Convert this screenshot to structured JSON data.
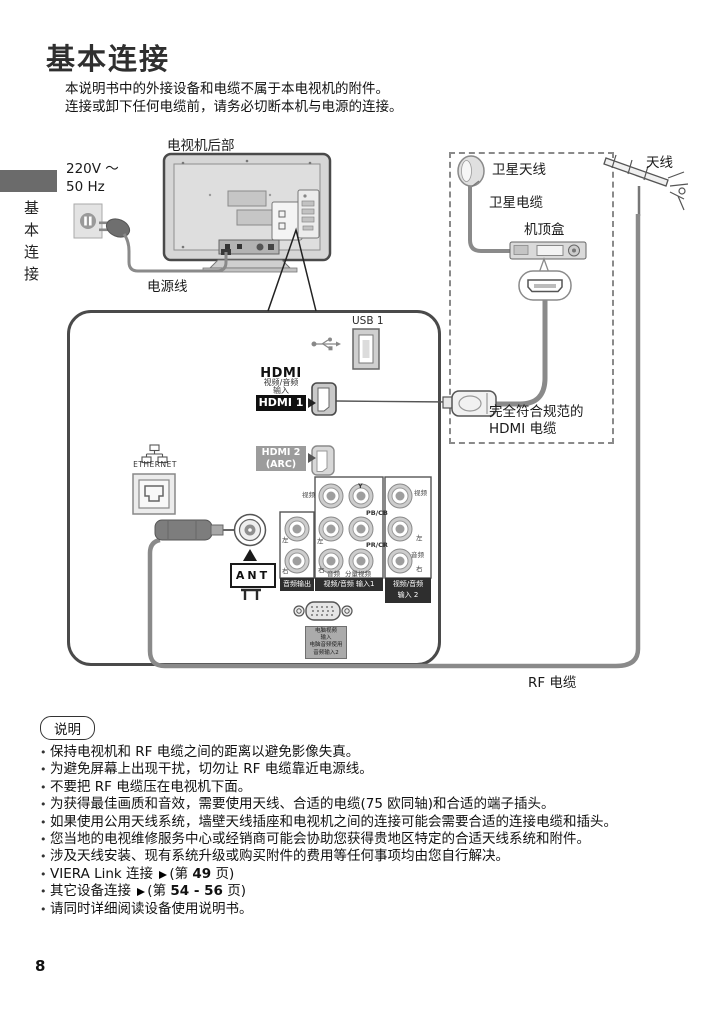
{
  "page_number": "8",
  "title": "基本连接",
  "intro_line1": "本说明书中的外接设备和电缆不属于本电视机的附件。",
  "intro_line2": "连接或卸下任何电缆前，请务必切断本机与电源的连接。",
  "sidebar_label": "基本连接",
  "diagram": {
    "tv_rear_label": "电视机后部",
    "voltage_line1": "220V ～",
    "voltage_line2": "50 Hz",
    "power_cord_label": "电源线",
    "satellite_dish_label": "卫星天线",
    "satellite_cable_label": "卫星电缆",
    "set_top_box_label": "机顶盒",
    "antenna_label": "天线",
    "hdmi_cable_label_line1": "完全符合规范的",
    "hdmi_cable_label_line2": "HDMI 电缆",
    "rf_cable_label": "RF 电缆",
    "usb_label": "USB 1",
    "hdmi_logo": "HDMI",
    "hdmi_caption_line1": "视频/音频",
    "hdmi_caption_line2": "输入",
    "hdmi1_label": "HDMI 1",
    "hdmi2_label_line1": "HDMI 2",
    "hdmi2_label_line2": "(ARC)",
    "ethernet_label": "ETHERNET",
    "ant_label": "ANT",
    "jack_labels": {
      "video": "视频",
      "y": "Y",
      "pb": "PB/CB",
      "pr": "PR/CR",
      "left": "左",
      "right": "右",
      "audio": "音频",
      "component": "分量视频"
    },
    "bar_audio_out": "音频输出",
    "bar_input1": "视频/音频 输入1",
    "bar_input2_line1": "视频/音频",
    "bar_input2_line2": "输入 2",
    "pc_label_line1": "电脑视频",
    "pc_label_line2": "输入",
    "pc_label_line3": "电脑音频使用",
    "pc_label_line4": "音频输入2"
  },
  "notes": {
    "header": "说明",
    "items": [
      "保持电视机和 RF 电缆之间的距离以避免影像失真。",
      "为避免屏幕上出现干扰，切勿让 RF 电缆靠近电源线。",
      "不要把 RF 电缆压在电视机下面。",
      "为获得最佳画质和音效，需要使用天线、合适的电缆(75 欧同轴)和合适的端子插头。",
      "如果使用公用天线系统，墙壁天线插座和电视机之间的连接可能会需要合适的连接电缆和插头。",
      "您当地的电视维修服务中心或经销商可能会协助您获得贵地区特定的合适天线系统和附件。",
      "涉及天线安装、现有系统升级或购买附件的费用等任何事项均由您自行解决。",
      {
        "prefix": "VIERA Link 连接 ",
        "mid": "(第 ",
        "bold": "49",
        "suffix": " 页)"
      },
      {
        "prefix": "其它设备连接 ",
        "mid": "(第 ",
        "bold": "54 - 56",
        "suffix": " 页)"
      },
      "请同时详细阅读设备使用说明书。"
    ]
  },
  "colors": {
    "ink": "#1a1a1a",
    "cable_gray": "#8a8a8a",
    "chip_black": "#0f0f0f",
    "chip_gray": "#9c9c9c",
    "sidebar_tab": "#6b6b6b"
  }
}
